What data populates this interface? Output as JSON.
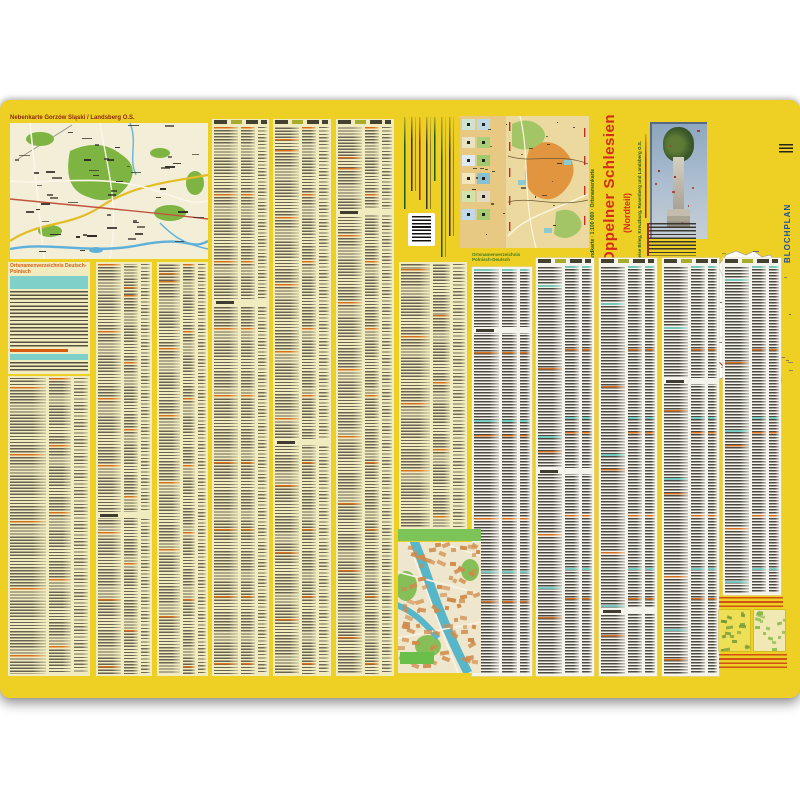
{
  "sheet": {
    "background": "#eecf23"
  },
  "inset_map": {
    "title": "Nebenkarte Gorzów Śląski / Landsberg O.S."
  },
  "left_index": {
    "heading": "Ortsnamenverzeichnis Deutsch-Polnisch"
  },
  "right_index": {
    "heading_line1": "Ortsnamenverzeichnis",
    "heading_line2": "Polnisch-Deutsch"
  },
  "cover": {
    "series_label": "Landkarte · 1:100 000 · Ortsnamenkarte",
    "title": "Oppelner Schlesien",
    "subtitle": "(Nordteil)",
    "region_label": "Kreise Brieg, Kreuzburg, Rosenberg und Landsberg O.S.",
    "publisher": "BLOCHPLAN"
  },
  "colors": {
    "title_red": "#d42c18",
    "publisher_blue": "#1d4fa0",
    "highlight_teal": "#7fd0c8",
    "entry_orange": "#e07a1e",
    "paper_yellow": "#f1ecbf",
    "paper_white": "#f4f3ec"
  }
}
